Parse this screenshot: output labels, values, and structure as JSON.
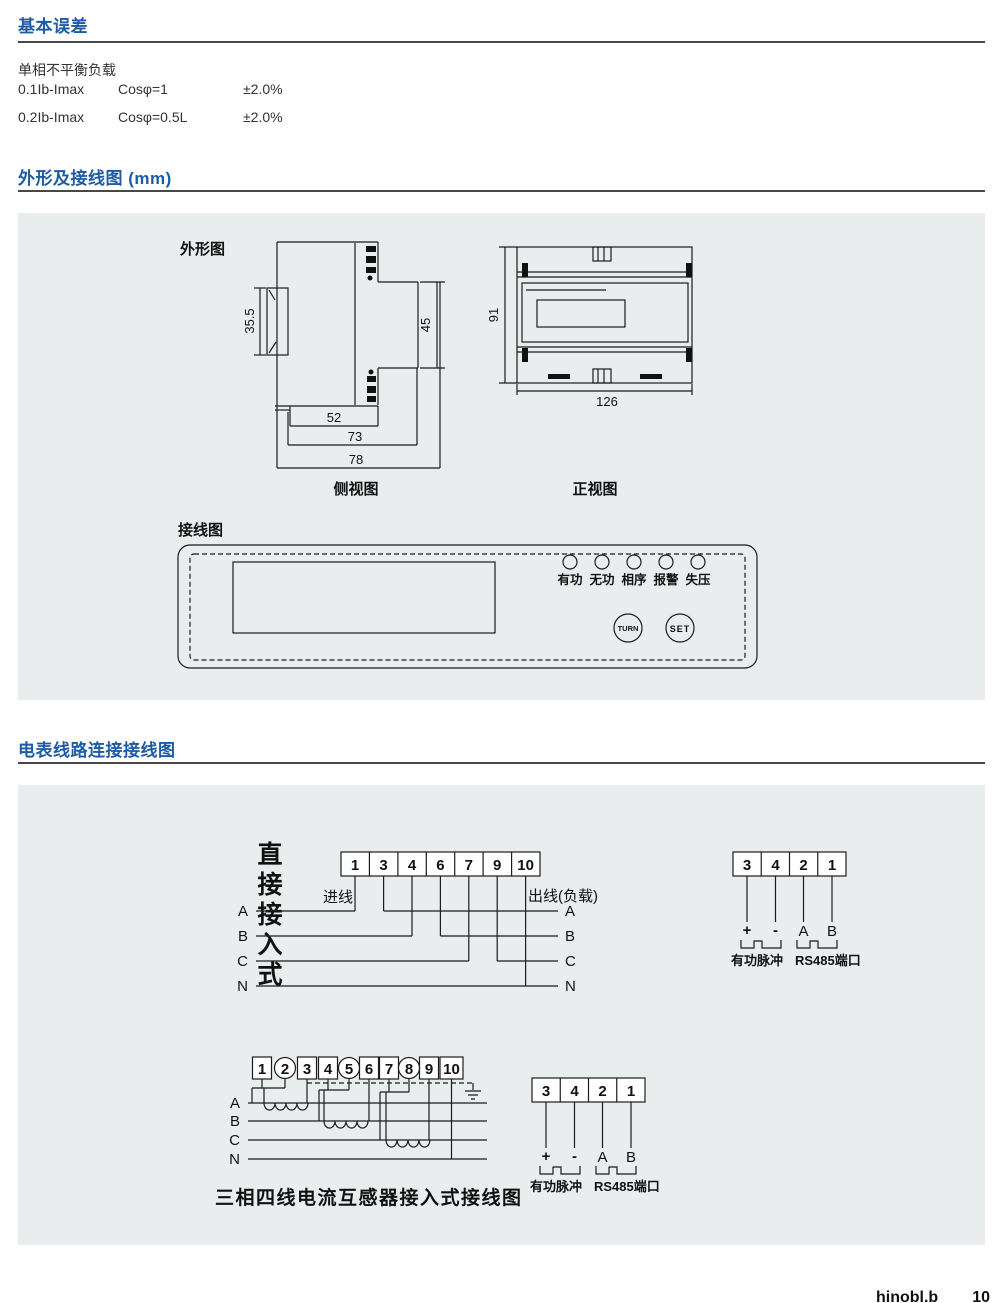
{
  "page": {
    "footer_text": "hinobl.b",
    "footer_page": "10"
  },
  "colors": {
    "heading_blue": "#1d5ba6",
    "rule_dark": "#474747",
    "panel_bg": "#e9edee",
    "line": "#1c1c1c"
  },
  "basic_error": {
    "title": "基本误差",
    "subtitle": "单相不平衡负载",
    "rows": [
      {
        "range": "0.1Ib-Imax",
        "cos": "Cosφ=1",
        "error": "±2.0%"
      },
      {
        "range": "0.2Ib-Imax",
        "cos": "Cosφ=0.5L",
        "error": "±2.0%"
      }
    ]
  },
  "outline": {
    "title": "外形及接线图 (mm)",
    "outline_label": "外形图",
    "side_caption": "侧视图",
    "front_caption": "正视图",
    "dims": {
      "clip_h": "35.5",
      "right_h": "45",
      "w1": "52",
      "w2": "73",
      "w3": "78",
      "front_h": "91",
      "front_w": "126"
    },
    "faceplate": {
      "label": "接线图",
      "leds": [
        "有功",
        "无功",
        "相序",
        "报警",
        "失压"
      ],
      "buttons": [
        "TURN",
        "SET"
      ]
    }
  },
  "meter_wiring": {
    "title": "电表线路连接接线图",
    "direct": {
      "mode_label": "直接接入式",
      "terminals": [
        "1",
        "3",
        "4",
        "6",
        "7",
        "9",
        "10"
      ],
      "in_label": "进线",
      "out_label": "出线(负载)",
      "phases": [
        "A",
        "B",
        "C",
        "N"
      ]
    },
    "pulse": {
      "terminals": [
        "3",
        "4",
        "2",
        "1"
      ],
      "pins": [
        "+",
        "-",
        "A",
        "B"
      ],
      "active_label": "有功脉冲",
      "rs485_label": "RS485端口"
    },
    "ct": {
      "terminals": [
        "1",
        "2",
        "3",
        "4",
        "5",
        "6",
        "7",
        "8",
        "9",
        "10"
      ],
      "phases": [
        "A",
        "B",
        "C",
        "N"
      ],
      "caption": "三相四线电流互感器接入式接线图"
    }
  }
}
